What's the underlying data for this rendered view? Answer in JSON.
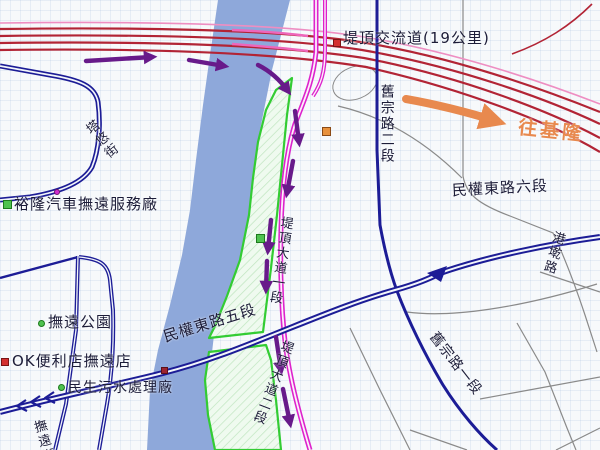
{
  "map": {
    "title_context": "street map around Tiding interchange and Keelung River",
    "labels": {
      "interchange": "堤頂交流道(19公里)",
      "to_keelung": "往基隆",
      "jiuzong_rd_sec2": "舊宗路二段",
      "jiuzong_rd_sec1": "舊宗路一段",
      "minquan_e_rd_sec6": "民權東路六段",
      "minquan_e_rd_sec5": "民權東路五段",
      "tiding_blvd_sec1": "堤頂大道一段",
      "tiding_blvd_sec2": "堤頂大道二段",
      "gangqian_rd": "港墘路",
      "tayou_st": "塔悠街",
      "fuyuan_st": "撫遠街",
      "poi_fuyuan_park": "撫遠公園",
      "poi_ok_store": "OK便利店撫遠店",
      "poi_yulon_service": "裕隆汽車撫遠服務廠",
      "poi_sewage_plant": "民生污水處理廠"
    },
    "colors": {
      "river": "#8ea8da",
      "park_fill": "#effaef",
      "park_border": "#33cc33",
      "highway_red": "#b22435",
      "highway_pink": "#ee8ec2",
      "expressway_magenta": "#dd22cc",
      "major_road_navy": "#1c1c96",
      "minor_road_gray": "#8a8a8a",
      "route_arrow_purple": "#681a8a",
      "direction_arrow_orange": "#e8894e",
      "label_text": "#1c1c38"
    }
  }
}
